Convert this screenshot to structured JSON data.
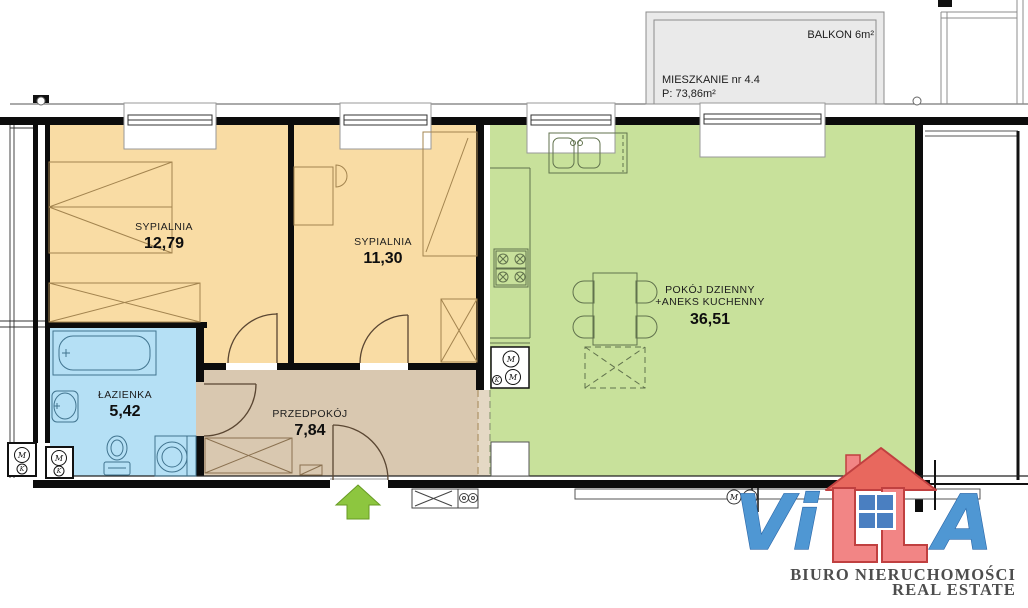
{
  "floorplan": {
    "apartment": {
      "title": "MIESZKANIE nr 4.4",
      "area": "P: 73,86m²"
    },
    "balcony": {
      "label": "BALKON 6m²"
    },
    "rooms": {
      "bedroom1": {
        "name": "SYPIALNIA",
        "area": "12,79"
      },
      "bedroom2": {
        "name": "SYPIALNIA",
        "area": "11,30"
      },
      "living": {
        "name": "POKÓJ DZIENNY",
        "name2": "+ANEKS KUCHENNY",
        "area": "36,51"
      },
      "bathroom": {
        "name": "ŁAZIENKA",
        "area": "5,42"
      },
      "hall": {
        "name": "PRZEDPOKÓJ",
        "area": "7,84"
      }
    },
    "meters": {
      "m": "M",
      "k": "K"
    },
    "colors": {
      "bedroom": "#F9DCA4",
      "living": "#C8E19B",
      "bathroom": "#B5E0F5",
      "hall": "#D9C8B0",
      "hall_strip": "#E4D8C4",
      "balcony": "#EAEAEA",
      "arrow": "#8DC63F"
    }
  },
  "logo": {
    "letters_vi": "Vi",
    "letter_a": "A",
    "line1": "BIURO NIERUCHOMOŚCI",
    "line2": "REAL ESTATE",
    "colors": {
      "blue": "#4F97D3",
      "red": "#F28585",
      "roof": "#E8685E",
      "outline": "#C04040",
      "text": "#4D4D4D"
    }
  }
}
